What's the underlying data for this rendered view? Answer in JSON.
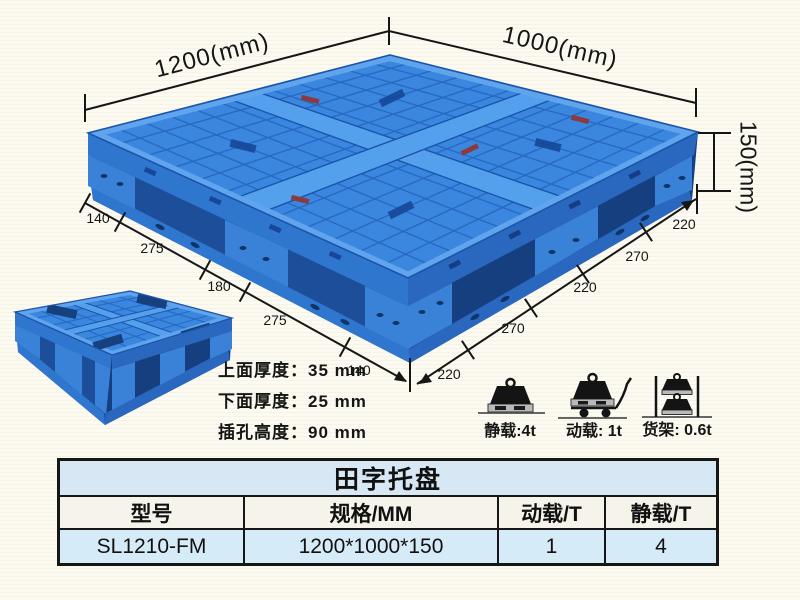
{
  "colors": {
    "page_bg": "#fcfaf1",
    "pallet_blue": "#3b87e0",
    "pallet_dark": "#1d4e99",
    "table_blue": "#d7e8f4",
    "table_header_bg": "#f6f3ea",
    "line_black": "#161616"
  },
  "icons": {
    "static": "weight-on-floor-icon",
    "dynamic": "weight-on-trolley-icon",
    "rack": "weights-on-rack-icon"
  },
  "dimensions": {
    "top_left": "1200(mm)",
    "top_right": "1000(mm)",
    "height": "150(mm)",
    "left_chain": [
      "140",
      "275",
      "180",
      "275",
      "140"
    ],
    "right_chain": [
      "220",
      "270",
      "220",
      "270",
      "220"
    ]
  },
  "specs": {
    "lines": [
      "上面厚度：35 mm",
      "下面厚度：25 mm",
      "插孔高度：90 mm"
    ]
  },
  "loads": {
    "static_label": "静载:4t",
    "dynamic_label": "动载: 1t",
    "rack_label": "货架: 0.6t"
  },
  "table": {
    "title": "田字托盘",
    "headers": [
      "型号",
      "规格/MM",
      "动载/T",
      "静载/T"
    ],
    "rows": [
      [
        "SL1210-FM",
        "1200*1000*150",
        "1",
        "4"
      ]
    ]
  }
}
